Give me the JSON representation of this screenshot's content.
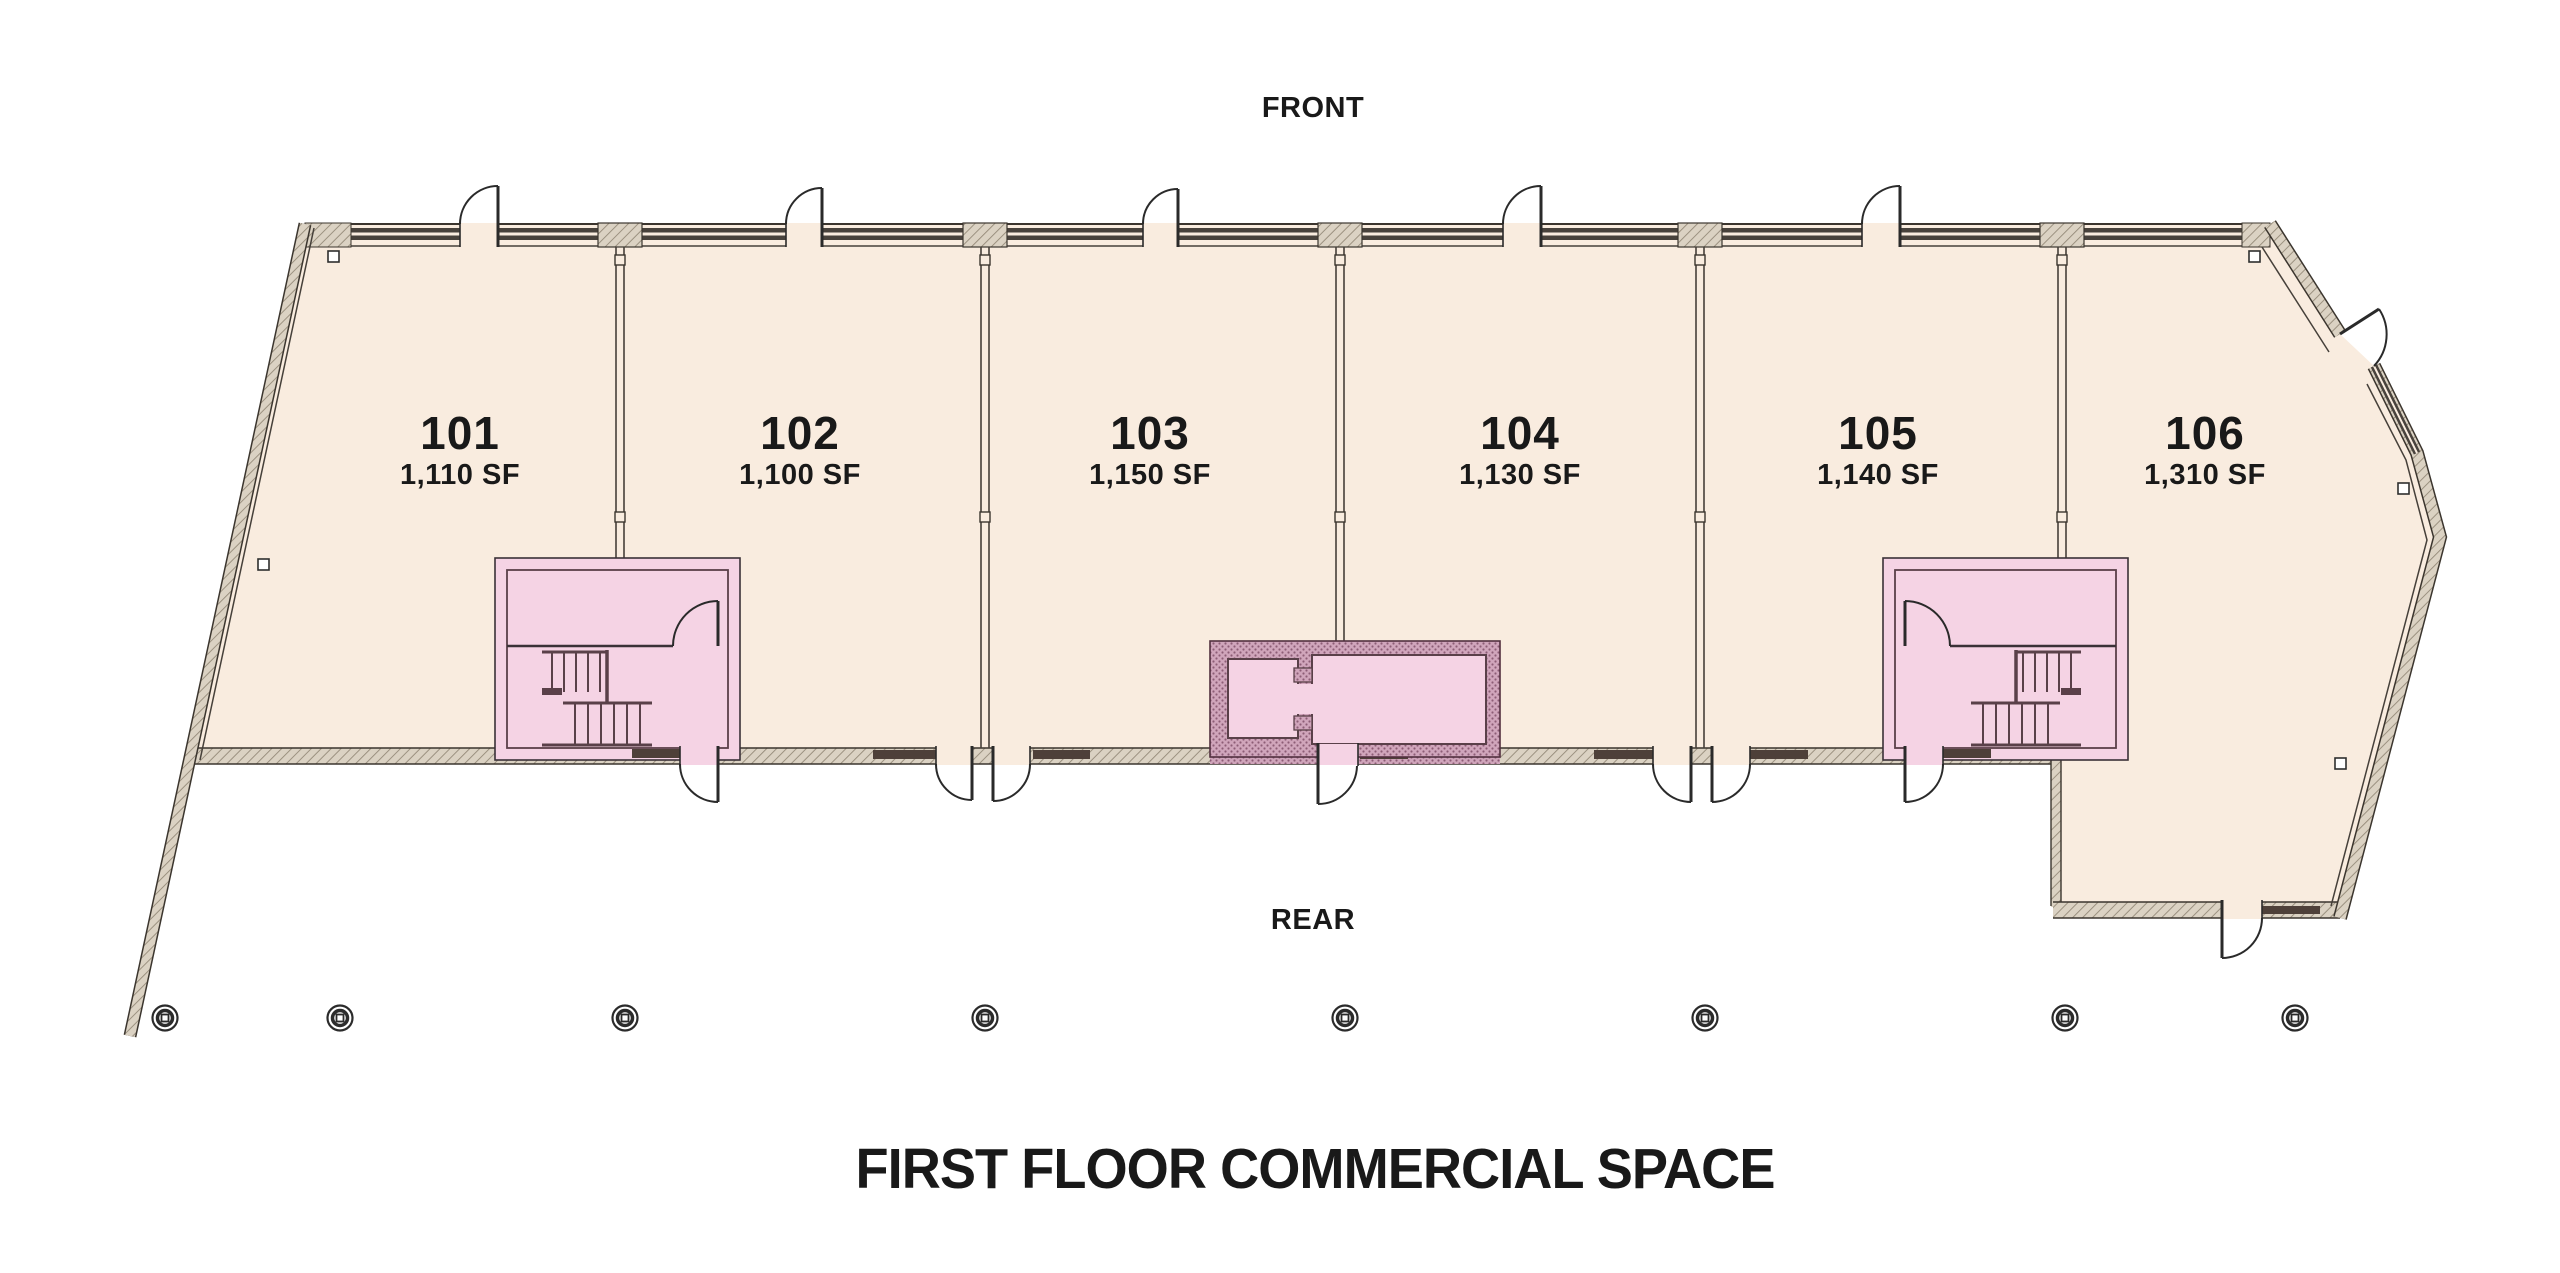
{
  "page": {
    "front_label": "FRONT",
    "rear_label": "REAR",
    "title": "FIRST FLOOR COMMERCIAL SPACE"
  },
  "units": [
    {
      "number": "101",
      "area": "1,110 SF"
    },
    {
      "number": "102",
      "area": "1,100 SF"
    },
    {
      "number": "103",
      "area": "1,150 SF"
    },
    {
      "number": "104",
      "area": "1,130 SF"
    },
    {
      "number": "105",
      "area": "1,140 SF"
    },
    {
      "number": "106",
      "area": "1,310 SF"
    }
  ],
  "colors": {
    "floor": "#f9ecdf",
    "stairwell_pink": "#f5d3e4",
    "shaft_mauve": "#d0a5bb",
    "wall_dark": "#3b352e",
    "glazing_dark": "#48423c",
    "stair_line": "#5a4049",
    "hatch_beige": "#dbd2c3",
    "text": "#191919"
  }
}
